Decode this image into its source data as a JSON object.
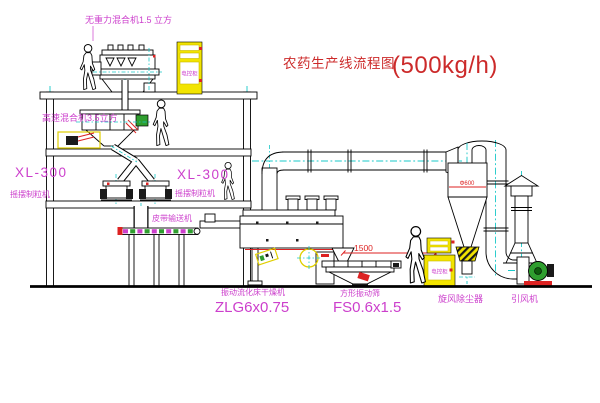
{
  "title": {
    "text": "农药生产线流程图",
    "capacity": "(500kg/h)"
  },
  "equipment": {
    "zero_gravity_mixer": {
      "label": "无重力混合机1.5 立方"
    },
    "high_speed_mixer": {
      "label": "高速混合机3.5立方"
    },
    "granulator_left": {
      "model": "XL-300",
      "name": "摇摆制粒机"
    },
    "granulator_right": {
      "model": "XL-300",
      "name": "摇摆制粒机"
    },
    "belt_conveyor": {
      "label": "皮带输送机"
    },
    "fluid_bed_dryer": {
      "name": "振动流化床干燥机",
      "model": "ZLG6x0.75"
    },
    "vibrating_sieve": {
      "name": "方形振动筛",
      "model": "FS0.6x1.5"
    },
    "cyclone": {
      "label": "旋风除尘器",
      "dia_dim": "Φ600"
    },
    "fan": {
      "label": "引风机"
    },
    "cabinet_top": {
      "text": "电控柜"
    },
    "cabinet_right": {
      "text": "电控柜"
    }
  },
  "dimensions": {
    "sieve_length": "1500",
    "sieve_height": "745"
  },
  "colors": {
    "line": "#000000",
    "centerline": "#18c8c8",
    "label_magenta": "#cc3fcc",
    "annotation_red": "#cc2a2a",
    "dimension_red": "#dd2222",
    "cabinet_yellow": "#f2e400",
    "motor_green": "#2f9e2f"
  }
}
